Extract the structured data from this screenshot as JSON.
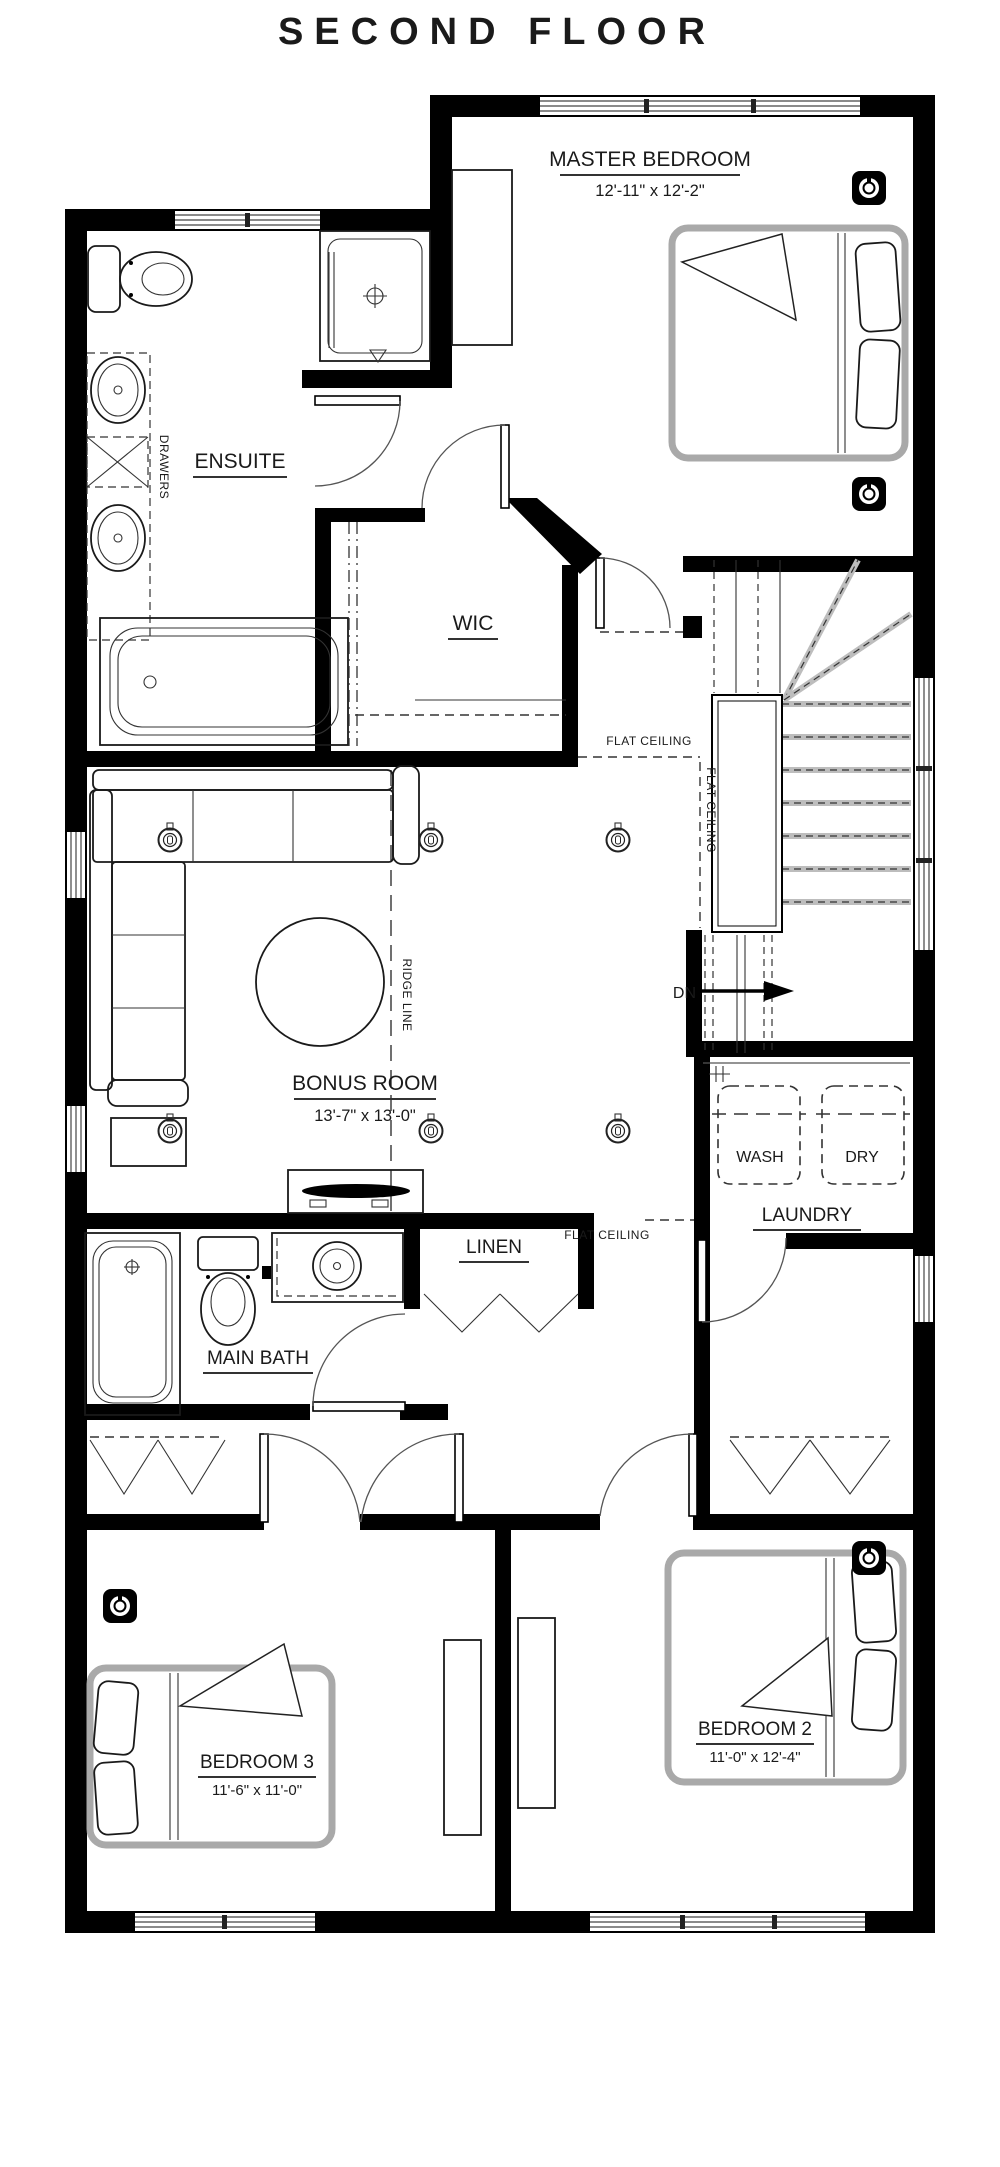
{
  "title": {
    "text": "SECOND FLOOR",
    "color": "#F5A54B"
  },
  "rooms": {
    "master_bedroom": {
      "name": "MASTER BEDROOM",
      "dims": "12'-11\" x 12'-2\""
    },
    "ensuite": {
      "name": "ENSUITE"
    },
    "wic": {
      "name": "WIC"
    },
    "bonus_room": {
      "name": "BONUS ROOM",
      "dims": "13'-7\" x 13'-0\""
    },
    "laundry": {
      "name": "LAUNDRY"
    },
    "linen": {
      "name": "LINEN"
    },
    "main_bath": {
      "name": "MAIN BATH"
    },
    "bedroom_2": {
      "name": "BEDROOM 2",
      "dims": "11'-0\" x 12'-4\""
    },
    "bedroom_3": {
      "name": "BEDROOM 3",
      "dims": "11'-6\" x 11'-0\""
    }
  },
  "appliances": {
    "washer": "WASH",
    "dryer": "DRY"
  },
  "annotations": {
    "stairs_down": "DN",
    "flat_ceiling": "FLAT CEILING",
    "ridge_line": "RIDGE LINE",
    "drawers": "DRAWERS"
  }
}
